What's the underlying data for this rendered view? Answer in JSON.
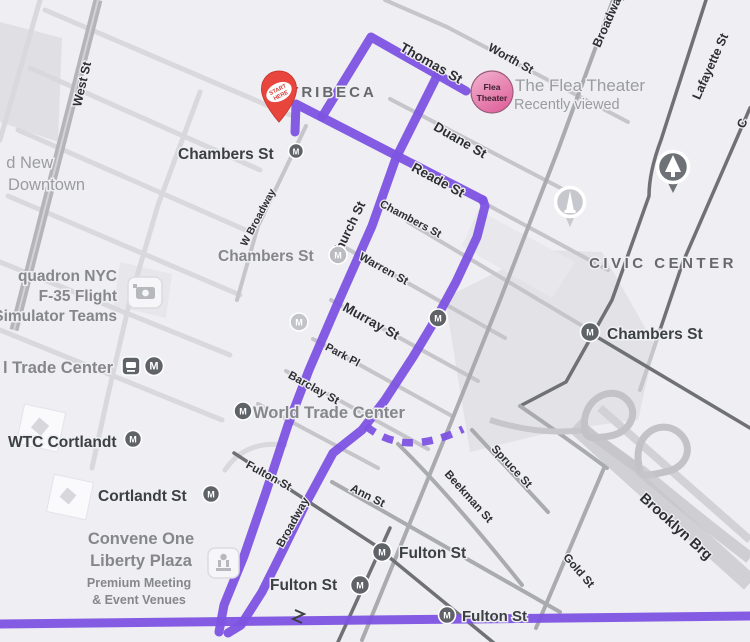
{
  "accent": {
    "route_purple": "#7d53e2",
    "pin_red": "#e8463d",
    "flea_pink": "#e0679f"
  },
  "icons": {
    "mta_letter": "M"
  },
  "areas": {
    "tribeca": "TRIBECA",
    "civic_center": "CIVIC CENTER",
    "downtown_line1": "d New",
    "downtown_line2": "Downtown"
  },
  "streets": {
    "west": "West St",
    "worth": "Worth St",
    "thomas": "Thomas St",
    "duane": "Duane St",
    "reade": "Reade St",
    "chambers": "Chambers St",
    "warren": "Warren St",
    "murray": "Murray St",
    "park_pl": "Park Pl",
    "barclay": "Barclay St",
    "church": "Church St",
    "w_broadway": "W Broadway",
    "broadway": "Broadway",
    "broadway_top": "Broadway",
    "fulton": "Fulton St",
    "ann": "Ann St",
    "beekman": "Beekman St",
    "spruce": "Spruce St",
    "gold": "Gold St",
    "lafayette": "Lafayette St",
    "brooklyn_brg": "Brooklyn Brg",
    "centre_partial": "C"
  },
  "pois": {
    "flea_title": "The Flea Theater",
    "flea_subtitle": "Recently viewed",
    "flea_badge_line1": "Flea",
    "flea_badge_line2": "Theater",
    "start_pin_line1": "START",
    "start_pin_line2": "HERE",
    "chambers_station_west": "Chambers St",
    "chambers_station_mid": "Chambers St",
    "chambers_station_east": "Chambers St",
    "squadron_line1": "quadron NYC",
    "squadron_line2": "F-35 Flight",
    "squadron_line3": "Simulator Teams",
    "trade_center_partial": "l Trade Center",
    "wtc_cortlandt": "WTC Cortlandt",
    "cortlandt_st": "Cortlandt St",
    "convene_line1": "Convene One",
    "convene_line2": "Liberty Plaza",
    "convene_line3": "Premium Meeting",
    "convene_line4": "& Event Venues",
    "world_trade_center": "World Trade Center",
    "fulton_station_center": "Fulton St",
    "fulton_station_west": "Fulton St",
    "fulton_station_southeast": "Fulton St"
  }
}
